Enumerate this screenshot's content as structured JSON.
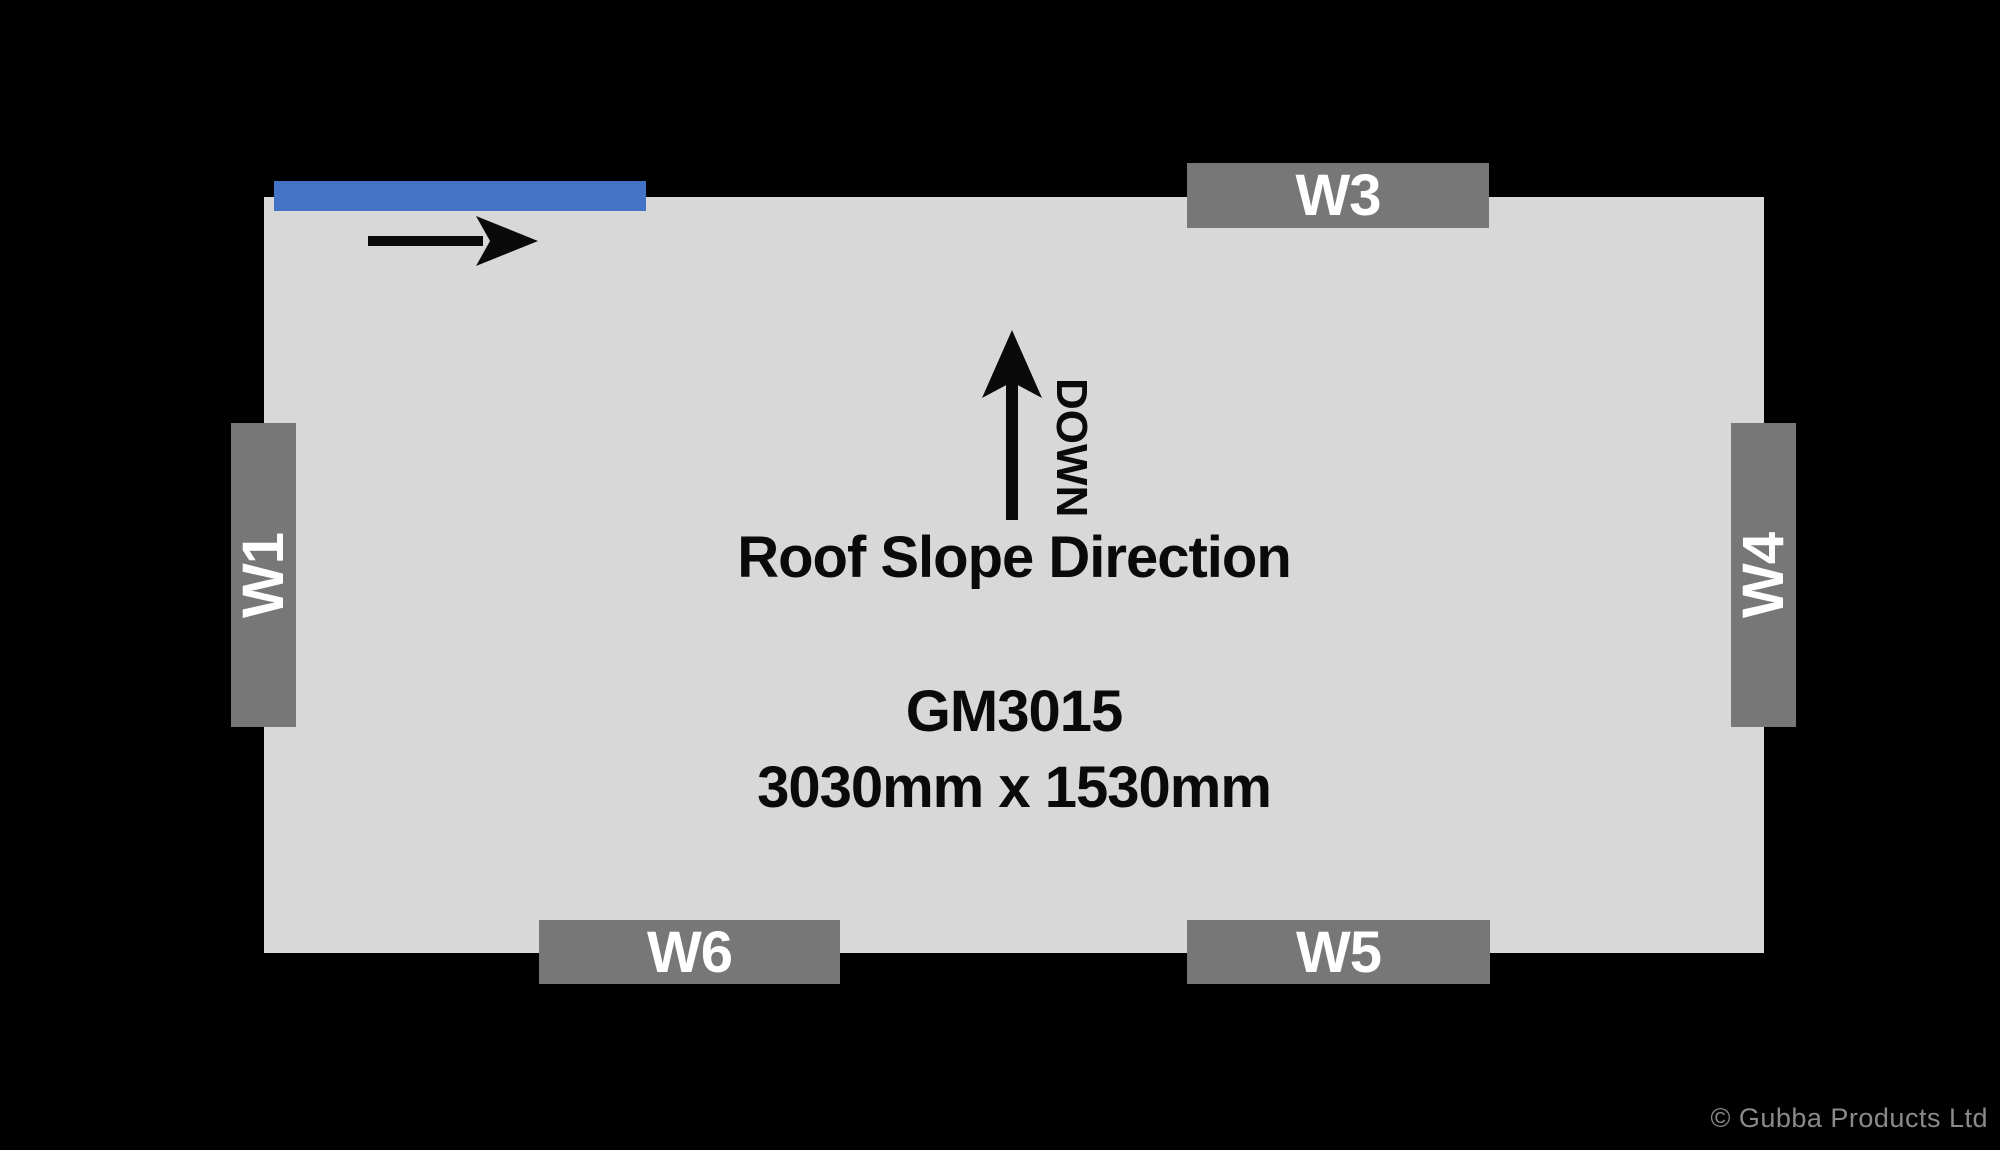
{
  "diagram": {
    "model": "GM3015",
    "dimensions": "3030mm x 1530mm",
    "roof_slope": {
      "label": "Roof Slope Direction",
      "down_label": "DOWN"
    }
  },
  "walls": [
    {
      "id": "W1",
      "label": "W1",
      "side": "left"
    },
    {
      "id": "W3",
      "label": "W3",
      "side": "top"
    },
    {
      "id": "W4",
      "label": "W4",
      "side": "right"
    },
    {
      "id": "W5",
      "label": "W5",
      "side": "bottom"
    },
    {
      "id": "W6",
      "label": "W6",
      "side": "bottom"
    }
  ],
  "icons": {
    "door_slide_arrow": "arrow-right-icon",
    "roof_slope_arrow": "arrow-up-icon"
  },
  "footer": {
    "copyright": "© Gubba Products Ltd"
  },
  "colors": {
    "background": "#000000",
    "floor": "#d8d8d8",
    "wall_label": "#777777",
    "door_accent": "#4472c4",
    "text": "#0a0a0a",
    "copyright_text": "#8a8a8a"
  }
}
